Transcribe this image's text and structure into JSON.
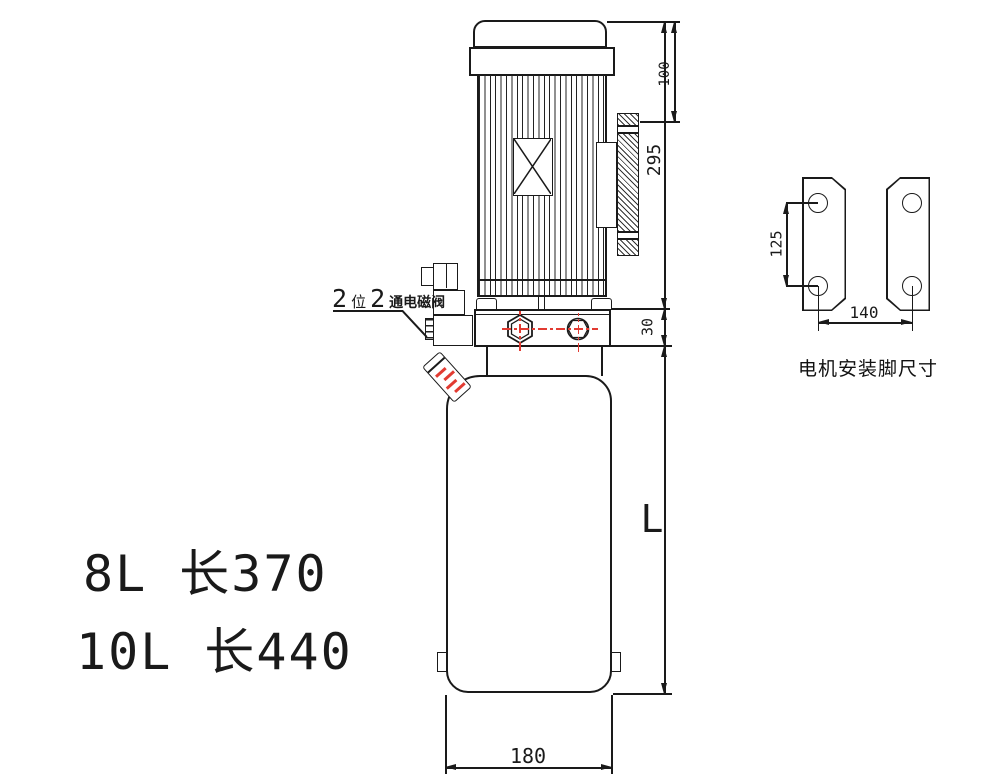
{
  "dims": {
    "d100": "100",
    "d295": "295",
    "d30": "30",
    "dL": "L",
    "d180": "180",
    "d125": "125",
    "d140": "140"
  },
  "valve_label": {
    "p1": "2",
    "p2": "位",
    "p3": "2",
    "p4": "通电磁阀"
  },
  "captions": {
    "bracket": "电机安装脚尺寸"
  },
  "specs": {
    "line1": "8L 长370",
    "line2": "10L 长440"
  },
  "colors": {
    "line": "#1a1a1a",
    "centerline": "#e23b32",
    "background": "#ffffff"
  }
}
